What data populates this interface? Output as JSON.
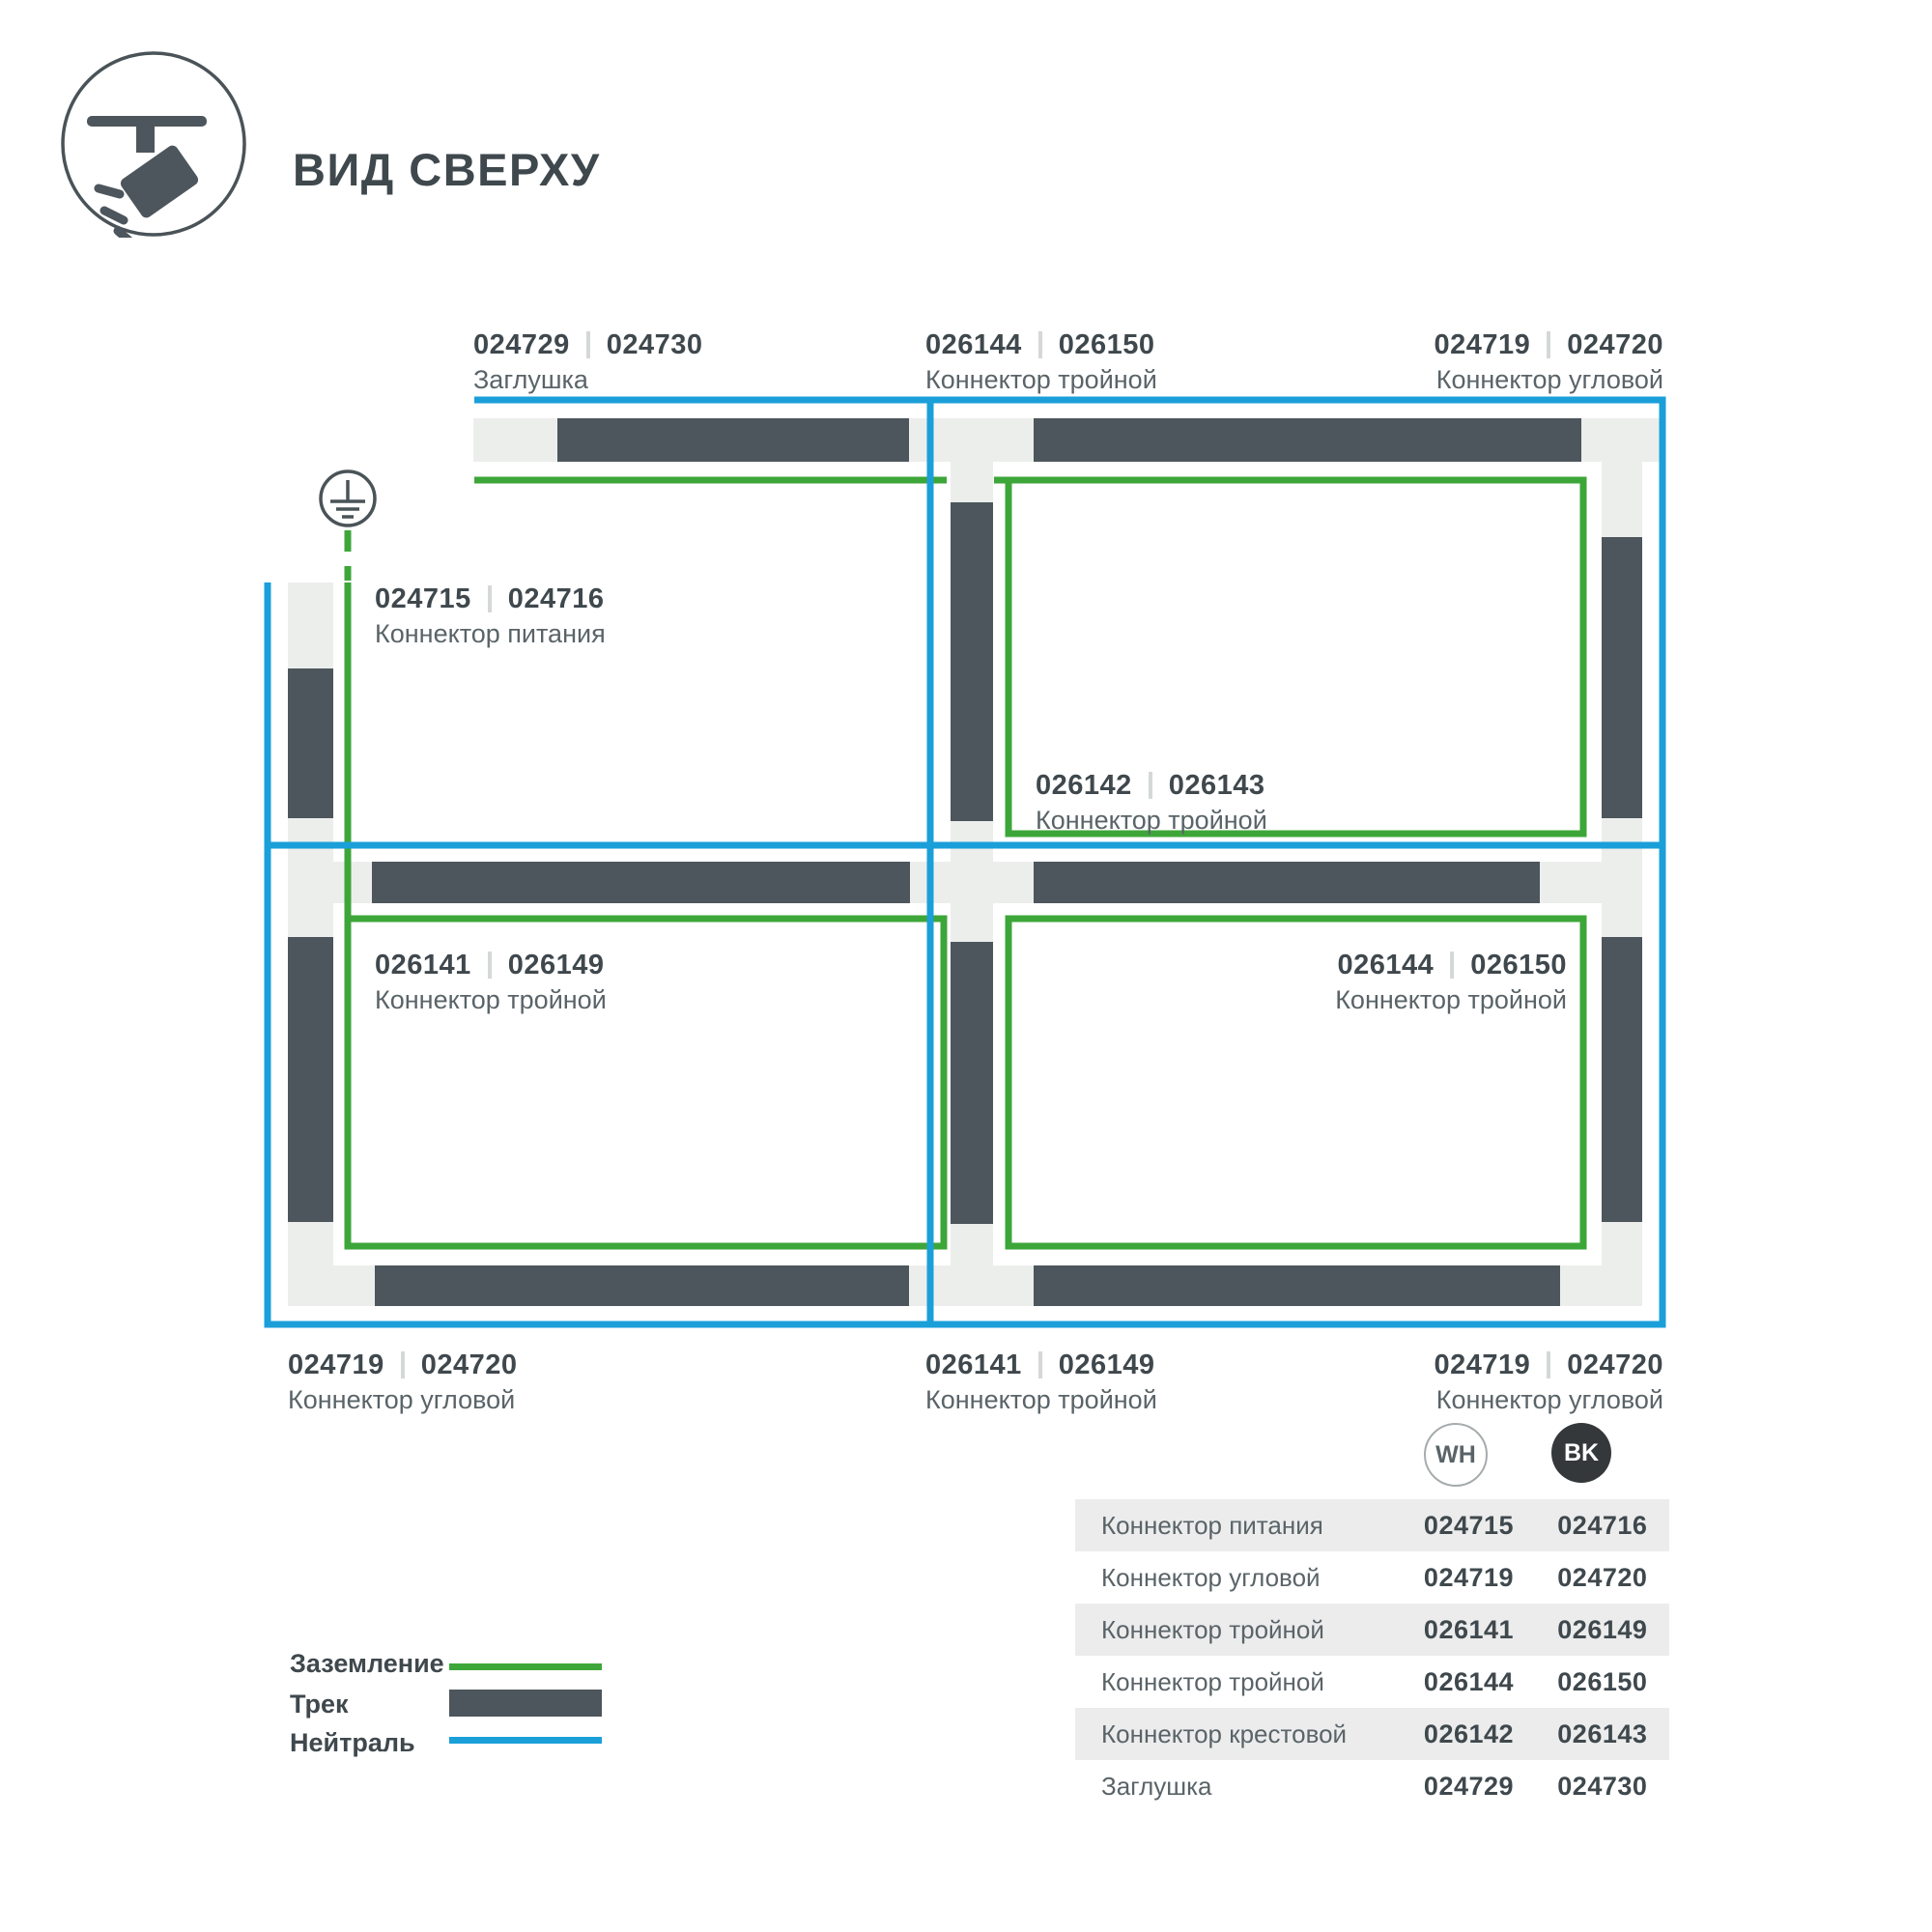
{
  "header": {
    "title": "ВИД СВЕРХУ",
    "icon": "track-spotlight-icon"
  },
  "colors": {
    "track": "#4d565c",
    "connector": "#eceeec",
    "ground": "#3da639",
    "neutral": "#1b9fd9",
    "text-dark": "#3f484d",
    "text-medium": "#5a6468",
    "separator": "#d5d8d8",
    "row-shade": "#ececec",
    "badge-bk-bg": "#34383b",
    "badge-border": "#a6abad",
    "outline": "#4a5358"
  },
  "labels": {
    "endcap_top": {
      "wh": "024729",
      "bk": "024730",
      "name": "Заглушка"
    },
    "tee_top": {
      "wh": "026144",
      "bk": "026150",
      "name": "Коннектор тройной"
    },
    "corner_top_right": {
      "wh": "024719",
      "bk": "024720",
      "name": "Коннектор угловой"
    },
    "power": {
      "wh": "024715",
      "bk": "024716",
      "name": "Коннектор питания"
    },
    "cross_center": {
      "wh": "026142",
      "bk": "026143",
      "name": "Коннектор тройной"
    },
    "tee_mid_left": {
      "wh": "026141",
      "bk": "026149",
      "name": "Коннектор тройной"
    },
    "tee_mid_right": {
      "wh": "026144",
      "bk": "026150",
      "name": "Коннектор тройной"
    },
    "corner_bottom_left": {
      "wh": "024719",
      "bk": "024720",
      "name": "Коннектор угловой"
    },
    "tee_bottom": {
      "wh": "026141",
      "bk": "026149",
      "name": "Коннектор тройной"
    },
    "corner_bottom_right": {
      "wh": "024719",
      "bk": "024720",
      "name": "Коннектор угловой"
    }
  },
  "legend": {
    "items": [
      {
        "label": "Заземление",
        "swatch": "ground-line"
      },
      {
        "label": "Трек",
        "swatch": "track-bar"
      },
      {
        "label": "Нейтраль",
        "swatch": "neutral-line"
      }
    ]
  },
  "table": {
    "columns": {
      "wh": "WH",
      "bk": "BK"
    },
    "rows": [
      {
        "name": "Коннектор питания",
        "wh": "024715",
        "bk": "024716"
      },
      {
        "name": "Коннектор угловой",
        "wh": "024719",
        "bk": "024720"
      },
      {
        "name": "Коннектор тройной",
        "wh": "026141",
        "bk": "026149"
      },
      {
        "name": "Коннектор тройной",
        "wh": "026144",
        "bk": "026150"
      },
      {
        "name": "Коннектор крестовой",
        "wh": "026142",
        "bk": "026143"
      },
      {
        "name": "Заглушка",
        "wh": "024729",
        "bk": "024730"
      }
    ]
  }
}
